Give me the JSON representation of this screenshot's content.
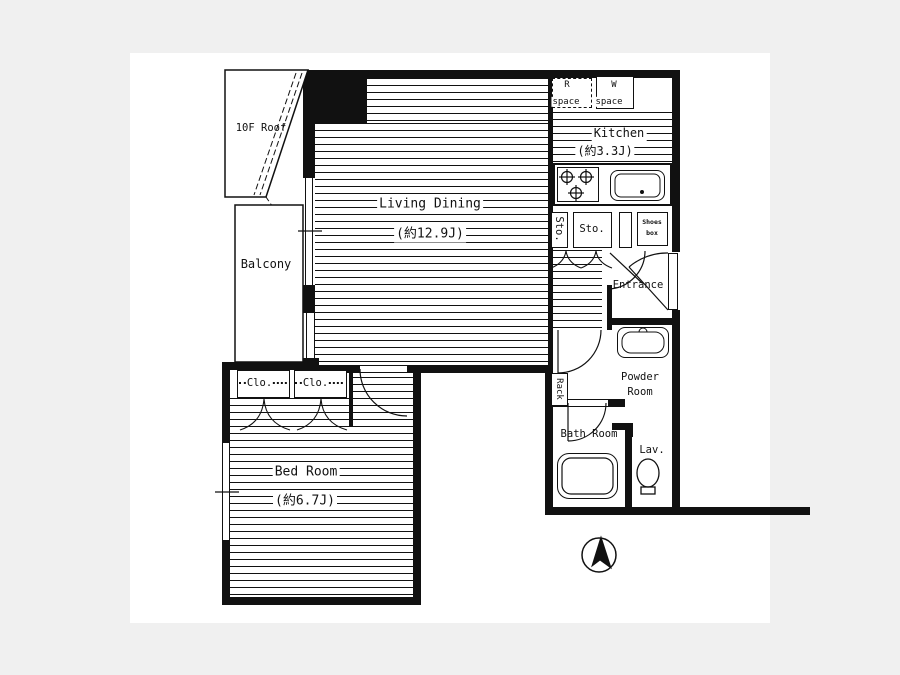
{
  "colors": {
    "page_bg": "#f0f0f0",
    "paper": "#ffffff",
    "ink": "#111111"
  },
  "plan": {
    "rooms": {
      "roof": {
        "label": "10F Roof"
      },
      "balcony": {
        "label": "Balcony"
      },
      "living_dining": {
        "label": "Living Dining",
        "area": "(約12.9J)"
      },
      "kitchen": {
        "label": "Kitchen",
        "area": "(約3.3J)"
      },
      "refrigerator_space": {
        "label": "R",
        "sub": "space"
      },
      "washer_space": {
        "label": "W",
        "sub": "space"
      },
      "storage_small": {
        "label": "Sto."
      },
      "storage": {
        "label": "Sto."
      },
      "shoes_box": {
        "line1": "Shoes",
        "line2": "box"
      },
      "entrance": {
        "label": "Entrance"
      },
      "powder_room": {
        "line1": "Powder",
        "line2": "Room"
      },
      "rack": {
        "label": "Rack"
      },
      "bath_room": {
        "label": "Bath Room"
      },
      "lavatory": {
        "label": "Lav."
      },
      "closet_left": {
        "label": "Clo."
      },
      "closet_right": {
        "label": "Clo."
      },
      "bed_room": {
        "label": "Bed Room",
        "area": "(約6.7J)"
      }
    },
    "compass": {
      "icon": "north-arrow-icon"
    }
  }
}
